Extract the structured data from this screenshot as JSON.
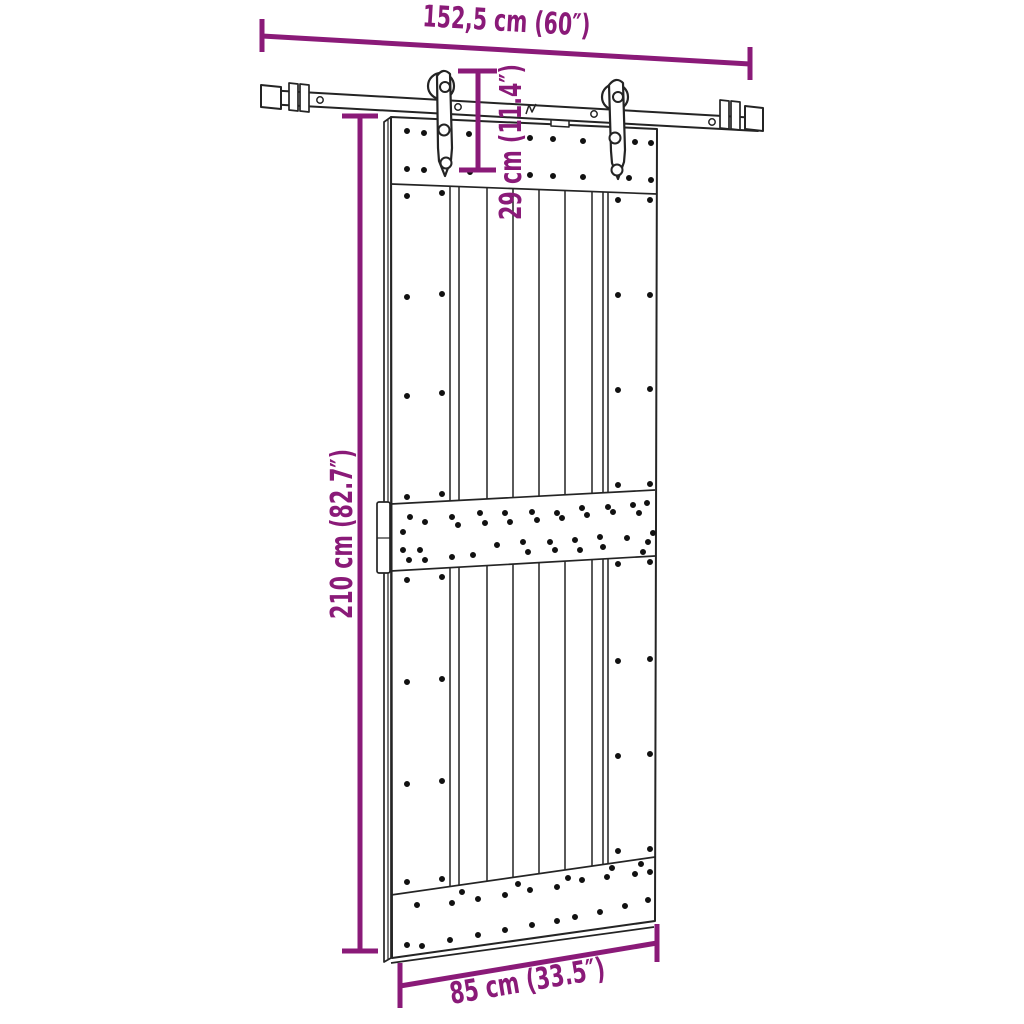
{
  "diagram": {
    "type": "product-dimension-diagram",
    "subject": "sliding barn door with rail hardware kit",
    "background_color": "#ffffff",
    "colors": {
      "dimension_accent": "#8A1A78",
      "drawing_line": "#242424",
      "dot": "#111111"
    },
    "dimensions": {
      "rail_width_label": "152,5 cm (60″)",
      "hanger_height_label": "29 cm (11.4″)",
      "door_height_label": "210 cm (82.7″)",
      "door_width_label": "85 cm (33.5″)"
    }
  }
}
